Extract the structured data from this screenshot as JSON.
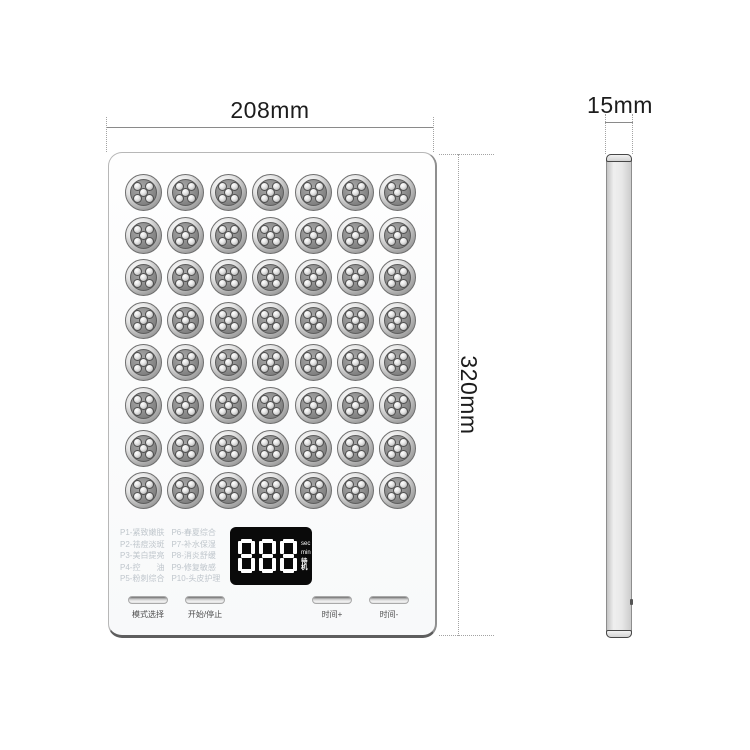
{
  "front_view": {
    "width_label": "208mm",
    "height_label": "320mm",
    "led_grid": {
      "rows": 8,
      "cols": 7,
      "leds_per_cluster": 5
    },
    "mode_list": {
      "column1": [
        "P1-紧致嫩肤",
        "P2-祛痘淡斑",
        "P3-美白提亮",
        "P4-控　　油",
        "P5-粉刺综合"
      ],
      "column2": [
        "P6-春夏综合",
        "P7-补水保湿",
        "P8-消炎舒缓",
        "P9-修复敏感",
        "P10-头皮护理"
      ]
    },
    "display": {
      "value": "888",
      "unit_labels": [
        "sec",
        "min",
        "待机"
      ]
    },
    "buttons": [
      {
        "label": "模式选择"
      },
      {
        "label": "开始/停止"
      },
      {
        "label": "时间+"
      },
      {
        "label": "时间-"
      }
    ]
  },
  "side_view": {
    "depth_label": "15mm"
  },
  "colors": {
    "display_bg": "#0a0a0a",
    "display_digits": "#ffffff",
    "mode_text": "#bfc6cc",
    "dimension_text": "#1c1c1c",
    "dimension_line": "#8a8a8a",
    "led_ring": "#d9d9d9",
    "led_disc": "#8b8b8b",
    "panel_bg": "#fbfbfc"
  }
}
